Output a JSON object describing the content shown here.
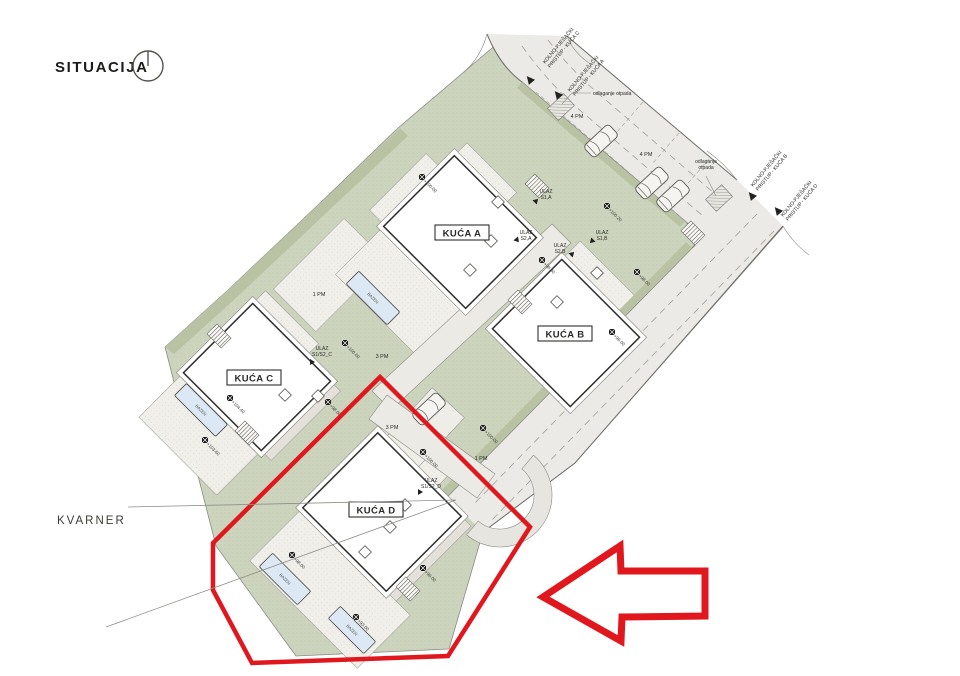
{
  "title": "SITUACIJA",
  "sea_label": "KVARNER",
  "pool_label": "BAZEN",
  "icons": {
    "north": "compass-north-icon",
    "highlight_arrow": "red-arrow-icon"
  },
  "colors": {
    "highlight_red": "#e0181e",
    "site_green": "#cdd4bd",
    "road_gray": "#ebeae6",
    "pool_blue": "#dce8f4"
  },
  "houses": [
    {
      "id": "A",
      "label": "KUĆA A",
      "cx": 460,
      "cy": 232,
      "w": 100,
      "h": 116,
      "rot": -45,
      "lx": 462,
      "ly": 233,
      "lights": [
        [
          498,
          202
        ],
        [
          491,
          241
        ],
        [
          470,
          270
        ]
      ]
    },
    {
      "id": "B",
      "label": "KUĆA B",
      "cx": 566,
      "cy": 333,
      "w": 98,
      "h": 110,
      "rot": -45,
      "lx": 565,
      "ly": 334,
      "lights": [
        [
          597,
          273
        ],
        [
          557,
          302
        ]
      ]
    },
    {
      "id": "C",
      "label": "KUĆA C",
      "cx": 257,
      "cy": 377,
      "w": 98,
      "h": 110,
      "rot": -45,
      "lx": 254,
      "ly": 378,
      "lights": [
        [
          285,
          395
        ],
        [
          318,
          396
        ]
      ]
    },
    {
      "id": "D",
      "label": "KUĆA D",
      "cx": 382,
      "cy": 512,
      "w": 106,
      "h": 118,
      "rot": -45,
      "lx": 376,
      "ly": 510,
      "lights": [
        [
          405,
          505
        ],
        [
          390,
          527
        ],
        [
          365,
          552
        ]
      ]
    }
  ],
  "pools": [
    {
      "x": 373,
      "y": 298,
      "w": 18,
      "h": 58
    },
    {
      "x": 201,
      "y": 410,
      "w": 17,
      "h": 58
    },
    {
      "x": 285,
      "y": 579,
      "w": 19,
      "h": 54
    },
    {
      "x": 352,
      "y": 630,
      "w": 17,
      "h": 50
    }
  ],
  "elevation_markers": [
    {
      "x": 422,
      "y": 177,
      "v": "+100.00"
    },
    {
      "x": 607,
      "y": 206,
      "v": "+100.20"
    },
    {
      "x": 542,
      "y": 260,
      "v": "+98.00"
    },
    {
      "x": 637,
      "y": 272,
      "v": "+98.00"
    },
    {
      "x": 612,
      "y": 332,
      "v": "+96.00"
    },
    {
      "x": 345,
      "y": 343,
      "v": "+100.00"
    },
    {
      "x": 230,
      "y": 398,
      "v": "+104.40"
    },
    {
      "x": 205,
      "y": 440,
      "v": "+103.60"
    },
    {
      "x": 328,
      "y": 402,
      "v": "+98.00"
    },
    {
      "x": 423,
      "y": 452,
      "v": "+100.00"
    },
    {
      "x": 483,
      "y": 428,
      "v": "+100.00"
    },
    {
      "x": 292,
      "y": 555,
      "v": "+98.00"
    },
    {
      "x": 356,
      "y": 617,
      "v": "+93.00"
    },
    {
      "x": 423,
      "y": 568,
      "v": "+96.00"
    }
  ],
  "labels": [
    {
      "name": "access-label-kuca-c",
      "x": 545,
      "y": 64,
      "rot": -50,
      "size": 5.2,
      "anchor": "start",
      "lh": 6.5,
      "lines": [
        "KOLNO-PJEŠAČKI",
        "PRISTUP - KUĆA C"
      ]
    },
    {
      "name": "access-label-kuca-a",
      "x": 570,
      "y": 92,
      "rot": -50,
      "size": 5.2,
      "anchor": "start",
      "lh": 6.5,
      "lines": [
        "KOLNO-PJEŠAČKI",
        "PRISTUP - KUĆA A"
      ]
    },
    {
      "name": "access-label-kuca-b",
      "x": 753,
      "y": 187,
      "rot": -50,
      "size": 5.2,
      "anchor": "start",
      "lh": 6.5,
      "lines": [
        "KOLNO-PJEŠAČKI",
        "PRISTUP - KUĆA B"
      ]
    },
    {
      "name": "access-label-kuca-d",
      "x": 783,
      "y": 217,
      "rot": -50,
      "size": 5.2,
      "anchor": "start",
      "lh": 6.5,
      "lines": [
        "KOLNO-PJEŠAČKI",
        "PRISTUP - KUĆA D"
      ]
    },
    {
      "name": "waste-label-1",
      "x": 593,
      "y": 95,
      "rot": 0,
      "size": 5,
      "anchor": "start",
      "lh": 6,
      "lines": [
        "odlaganje otpada"
      ]
    },
    {
      "name": "waste-label-2",
      "x": 706,
      "y": 163,
      "rot": 0,
      "size": 5,
      "anchor": "middle",
      "lh": 6,
      "lines": [
        "odlaganje",
        "otpada"
      ]
    },
    {
      "name": "entrance-label-s1a",
      "x": 546,
      "y": 193,
      "rot": 0,
      "size": 5,
      "anchor": "middle",
      "lh": 6,
      "lines": [
        "ULAZ",
        "S1,A"
      ]
    },
    {
      "name": "entrance-label-s2a",
      "x": 526,
      "y": 234,
      "rot": 0,
      "size": 5,
      "anchor": "middle",
      "lh": 6,
      "lines": [
        "ULAZ",
        "S2,A"
      ]
    },
    {
      "name": "entrance-label-s2b",
      "x": 560,
      "y": 247,
      "rot": 0,
      "size": 5,
      "anchor": "middle",
      "lh": 6,
      "lines": [
        "ULAZ",
        "S2,B"
      ]
    },
    {
      "name": "entrance-label-s1b",
      "x": 602,
      "y": 234,
      "rot": 0,
      "size": 5,
      "anchor": "middle",
      "lh": 6,
      "lines": [
        "ULAZ",
        "S1,B"
      ]
    },
    {
      "name": "entrance-label-s1s2c",
      "x": 322,
      "y": 350,
      "rot": 0,
      "size": 5,
      "anchor": "middle",
      "lh": 6,
      "lines": [
        "ULAZ",
        "S1/S2_C"
      ]
    },
    {
      "name": "entrance-label-s1s2d",
      "x": 431,
      "y": 482,
      "rot": 0,
      "size": 5,
      "anchor": "middle",
      "lh": 6,
      "lines": [
        "ULAZ",
        "S1/S2_D"
      ]
    },
    {
      "name": "parking-label-4pm-1",
      "x": 577,
      "y": 118,
      "rot": 0,
      "size": 5.5,
      "anchor": "middle",
      "lh": 6,
      "lines": [
        "4 PM"
      ]
    },
    {
      "name": "parking-label-4pm-2",
      "x": 646,
      "y": 156,
      "rot": 0,
      "size": 5.5,
      "anchor": "middle",
      "lh": 6,
      "lines": [
        "4 PM"
      ]
    },
    {
      "name": "parking-label-1pm-1",
      "x": 319,
      "y": 296,
      "rot": 0,
      "size": 5.5,
      "anchor": "middle",
      "lh": 6,
      "lines": [
        "1 PM"
      ]
    },
    {
      "name": "parking-label-3pm-1",
      "x": 382,
      "y": 358,
      "rot": 0,
      "size": 5.5,
      "anchor": "middle",
      "lh": 6,
      "lines": [
        "3 PM"
      ]
    },
    {
      "name": "parking-label-3pm-2",
      "x": 392,
      "y": 429,
      "rot": 0,
      "size": 5.5,
      "anchor": "middle",
      "lh": 6,
      "lines": [
        "3 PM"
      ]
    },
    {
      "name": "parking-label-1pm-2",
      "x": 481,
      "y": 460,
      "rot": 0,
      "size": 5.5,
      "anchor": "middle",
      "lh": 6,
      "lines": [
        "1 PM"
      ]
    }
  ]
}
